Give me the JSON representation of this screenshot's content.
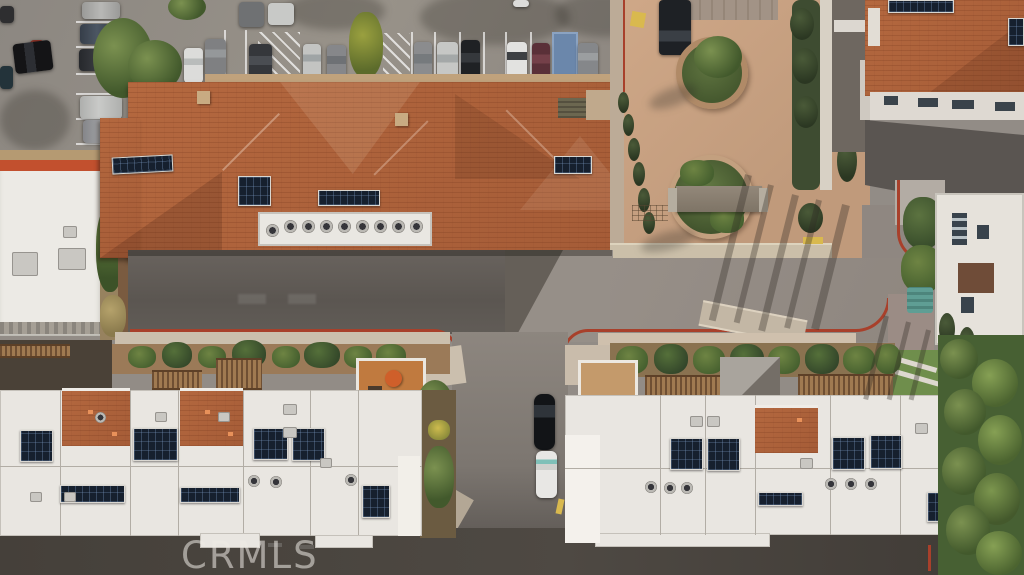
{
  "watermark": {
    "text": "CRMLS"
  },
  "scene": {
    "type": "aerial-photo",
    "subject": "overhead drone view of a residential complex: tile-roof building with solar panels, parking lots with cars, tan courtyard with circular planters and cypress trees, white flat-roof townhouses with rooftop decks and solar arrays, streets with red curbs"
  },
  "palette": {
    "asphalt_light": "#928c86",
    "asphalt_dark": "#5f5a55",
    "alley_dark": "#443f3a",
    "terracotta": "#b4683f",
    "white_roof": "#e9e6e1",
    "solar_panel": "#16202e",
    "courtyard_tan": "#c9a284",
    "curb_red": "#a8402b",
    "curb_yellow": "#d9b94e",
    "landscape_green": "#55673c",
    "cypress_green": "#39462e",
    "grass_green": "#6f8e4c"
  }
}
